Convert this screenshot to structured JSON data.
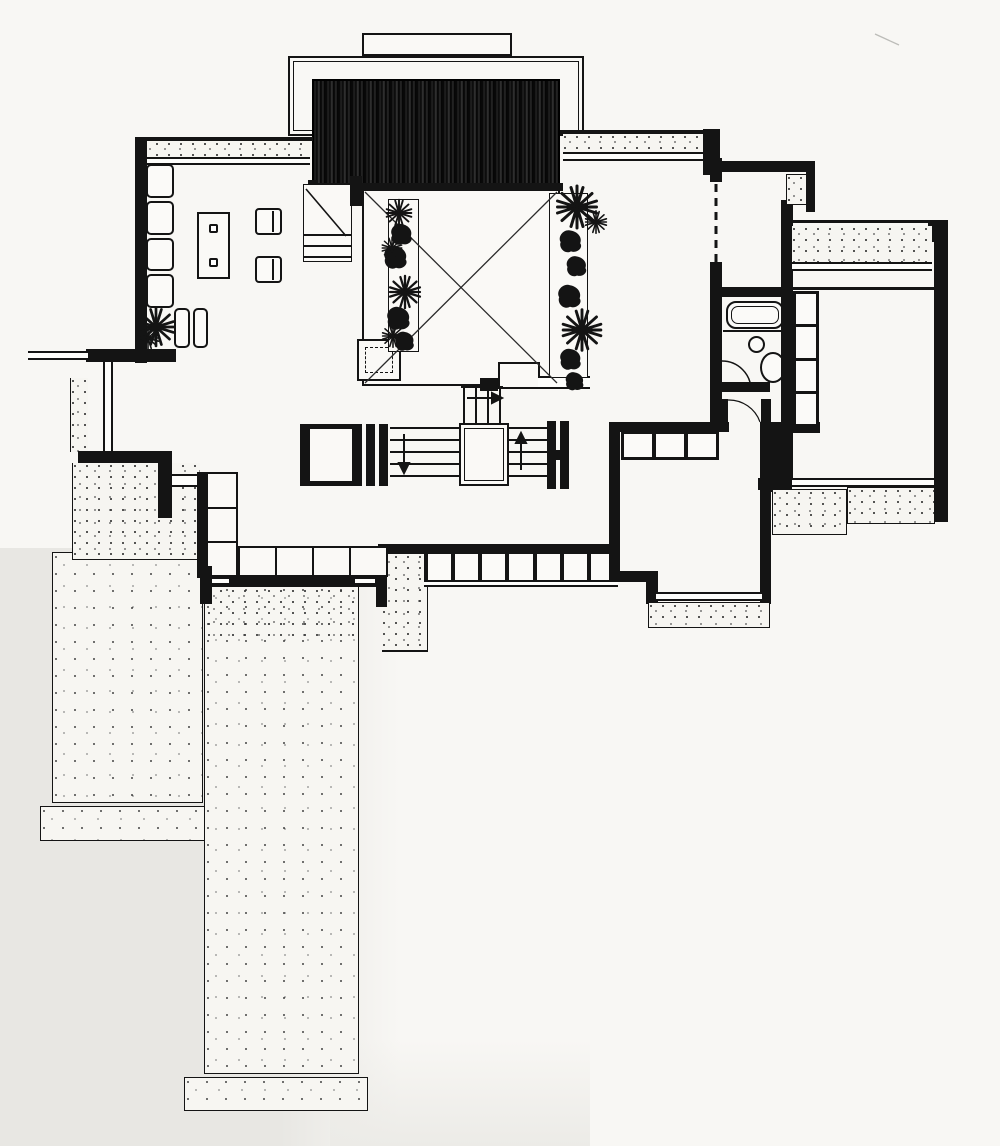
{
  "meta": {
    "type": "architectural-floor-plan",
    "description": "Ink-on-paper first floor plan of a modern house: living room with L-sofa, central atrium courtyard marked with an X and flanked by planting beds, split-level stair with direction arrows, bathroom, bedrooms with closet bands, and stepped stippled terraces.",
    "text_labels": []
  },
  "palette": {
    "ink": "#141414",
    "paper": "#f8f7f4",
    "paper_shade": "#e8e7e3",
    "terrace_fill": "#f6f5f1"
  },
  "counts": {
    "window_band_cells": 7,
    "bedroom_closet_cells": 3,
    "bath_closet_cells": 4,
    "bench_vertical_cells": 3,
    "bench_horizontal_cells": 4,
    "sofa_vertical_cushions": 4,
    "sofa_horizontal_cushions": 2
  },
  "features": {
    "stair_arrows": [
      "right",
      "down",
      "up"
    ],
    "door_swings": 2,
    "planting_beds": 2,
    "atrium_marking": "X diagonals",
    "trellis": "dark vertical-slat screen at clerestory"
  }
}
